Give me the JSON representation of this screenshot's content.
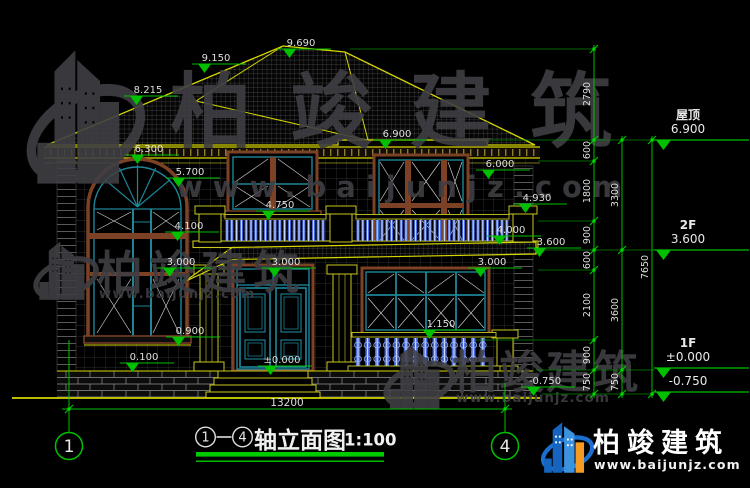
{
  "drawing_title": {
    "axis_from": "1",
    "axis_to": "4",
    "name": "轴立面图",
    "scale": "1:100"
  },
  "axes": {
    "left": "1",
    "right": "4"
  },
  "bottom_dim": "13200",
  "brand": {
    "name": "柏竣建筑",
    "url": "www.baijunjz.com"
  },
  "watermark": {
    "name": "柏竣建筑",
    "url": "www.baijunjz.com"
  },
  "colors": {
    "cad_yellow": "#d6d600",
    "cad_green": "#00c000",
    "frame_maroon": "#7d4226",
    "sash_teal": "#1d8596",
    "baluster_blue": "#4a6be0",
    "brand_blue": "#1565c0",
    "brand_orange": "#f59a23",
    "watermark_gray": "#3f3f44"
  },
  "levels": [
    {
      "label": "屋顶",
      "value": "6.900",
      "y": 140
    },
    {
      "label": "2F",
      "value": "3.600",
      "y": 250
    },
    {
      "label": "1F",
      "value": "±0.000",
      "y": 368
    },
    {
      "label": "",
      "value": "-0.750",
      "y": 392
    }
  ],
  "annotations": [
    {
      "t": "9.690",
      "x": 301,
      "y": 49
    },
    {
      "t": "9.150",
      "x": 216,
      "y": 64
    },
    {
      "t": "8.215",
      "x": 148,
      "y": 96
    },
    {
      "t": "6.900",
      "x": 397,
      "y": 140
    },
    {
      "t": "6.300",
      "x": 149,
      "y": 155
    },
    {
      "t": "6.000",
      "x": 500,
      "y": 170
    },
    {
      "t": "5.700",
      "x": 190,
      "y": 178
    },
    {
      "t": "4.930",
      "x": 537,
      "y": 204
    },
    {
      "t": "4.750",
      "x": 280,
      "y": 211
    },
    {
      "t": "4.100",
      "x": 189,
      "y": 232
    },
    {
      "t": "4.000",
      "x": 511,
      "y": 236
    },
    {
      "t": "3.600",
      "x": 551,
      "y": 248
    },
    {
      "t": "3.000",
      "x": 181,
      "y": 268
    },
    {
      "t": "3.000",
      "x": 286,
      "y": 268
    },
    {
      "t": "3.000",
      "x": 492,
      "y": 268
    },
    {
      "t": "1.150",
      "x": 441,
      "y": 330
    },
    {
      "t": "0.900",
      "x": 190,
      "y": 337
    },
    {
      "t": "0.100",
      "x": 144,
      "y": 363
    },
    {
      "t": "±0.000",
      "x": 282,
      "y": 366
    },
    {
      "t": "-0.750",
      "x": 545,
      "y": 387
    }
  ],
  "dim_chains": [
    {
      "x": 594,
      "ticks": [
        49,
        140,
        161,
        221,
        250,
        270,
        340,
        370,
        394
      ],
      "labels": [
        {
          "t": "2790",
          "y": 94
        },
        {
          "t": "600",
          "y": 150
        },
        {
          "t": "1800",
          "y": 191
        },
        {
          "t": "900",
          "y": 235
        },
        {
          "t": "600",
          "y": 260
        },
        {
          "t": "2100",
          "y": 305
        },
        {
          "t": "900",
          "y": 355
        },
        {
          "t": "750",
          "y": 382
        }
      ]
    },
    {
      "x": 622,
      "ticks": [
        140,
        250,
        370,
        394
      ],
      "labels": [
        {
          "t": "3300",
          "y": 195
        },
        {
          "t": "3600",
          "y": 310
        },
        {
          "t": "750",
          "y": 382
        }
      ]
    },
    {
      "x": 652,
      "ticks": [
        140,
        394
      ],
      "labels": [
        {
          "t": "7650",
          "y": 267
        }
      ]
    }
  ]
}
